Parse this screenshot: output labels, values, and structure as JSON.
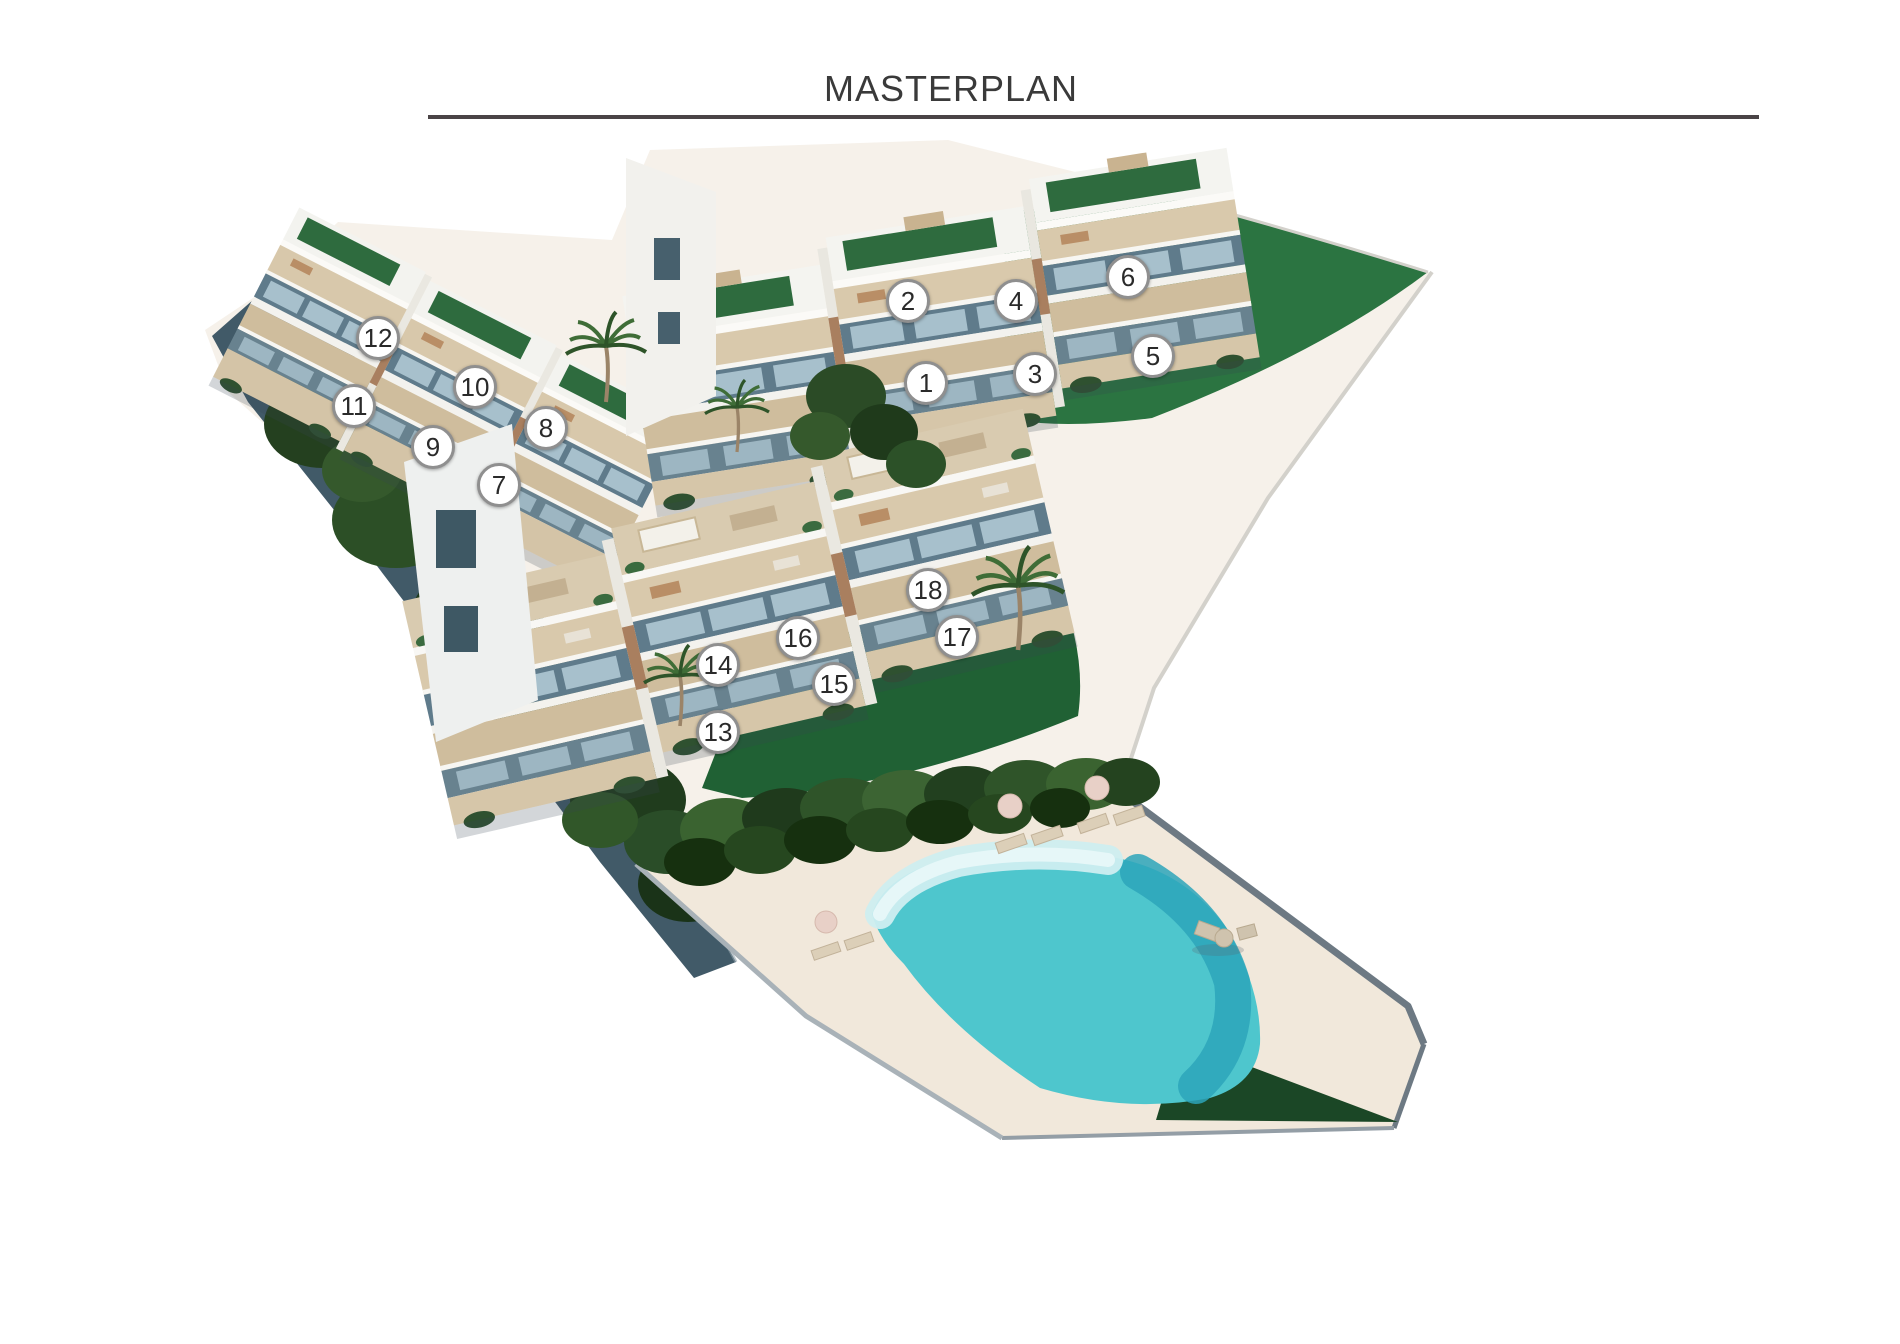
{
  "header": {
    "title": "MASTERPLAN",
    "title_color": "#3a3a3a",
    "divider_color": "#4a4446"
  },
  "masterplan": {
    "type": "residential-site-plan",
    "units_total": 18,
    "marker_style": {
      "diameter": 44,
      "fill": "#ffffff",
      "ring_color": "#8f8f8f",
      "number_color": "#2a2a2a"
    },
    "markers": [
      {
        "label": "1",
        "x": 926,
        "y": 383
      },
      {
        "label": "2",
        "x": 908,
        "y": 301
      },
      {
        "label": "3",
        "x": 1035,
        "y": 374
      },
      {
        "label": "4",
        "x": 1016,
        "y": 301
      },
      {
        "label": "5",
        "x": 1153,
        "y": 356
      },
      {
        "label": "6",
        "x": 1128,
        "y": 277
      },
      {
        "label": "7",
        "x": 499,
        "y": 485
      },
      {
        "label": "8",
        "x": 546,
        "y": 428
      },
      {
        "label": "9",
        "x": 433,
        "y": 447
      },
      {
        "label": "10",
        "x": 475,
        "y": 387
      },
      {
        "label": "11",
        "x": 354,
        "y": 406
      },
      {
        "label": "12",
        "x": 378,
        "y": 338
      },
      {
        "label": "13",
        "x": 718,
        "y": 732
      },
      {
        "label": "14",
        "x": 718,
        "y": 665
      },
      {
        "label": "15",
        "x": 834,
        "y": 684
      },
      {
        "label": "16",
        "x": 798,
        "y": 638
      },
      {
        "label": "17",
        "x": 957,
        "y": 637
      },
      {
        "label": "18",
        "x": 928,
        "y": 590
      }
    ]
  },
  "palette": {
    "page_background": "#ffffff",
    "path_cream": "#f6f1ea",
    "pool_deck": "#f1e8db",
    "lawn_green": "#2b7441",
    "lawn_dark_green": "#206134",
    "corner_lawn_green": "#1b4726",
    "vegetation_dark": "#24401f",
    "slope_shadow": "#415a68",
    "pool_water": "#4ec6cd",
    "pool_water_deep": "#2da5ba",
    "pool_water_light": "#cdeef0",
    "building_white": "#f4f4f0",
    "terrace_beige": "#d9c9ac",
    "window_glass": "#5f7b8b",
    "roof_green": "#2e6b3e"
  }
}
